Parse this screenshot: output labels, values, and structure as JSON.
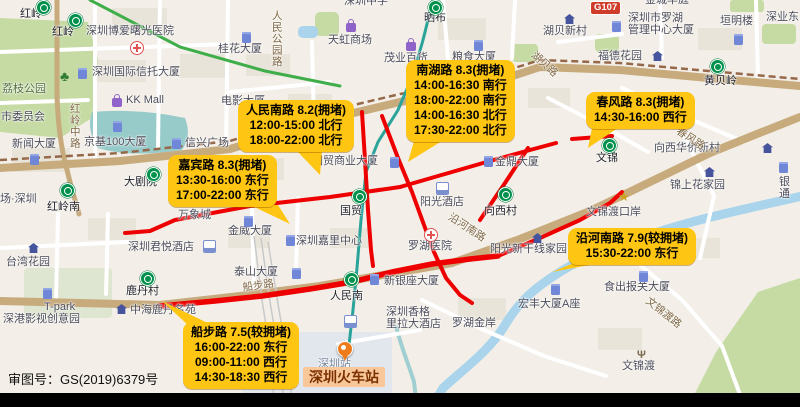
{
  "colors": {
    "callout": "#ffc513",
    "congestion": "#ee0000",
    "stationbg": "#f8c79a"
  },
  "map": {
    "attribution": "审图号：GS(2019)6379号",
    "road_badge": "G107",
    "station_highlight": "深圳火车站",
    "callouts": [
      {
        "title": "人民南路 8.2(拥堵)",
        "lines": [
          "12:00-15:00 北行",
          "18:00-22:00 北行"
        ],
        "left": 238,
        "top": 100,
        "tail": "296,150 322,150 320,175"
      },
      {
        "title": "南湖路 8.3(拥堵)",
        "lines": [
          "14:00-16:30 南行",
          "18:00-22:00 南行",
          "14:00-16:30 北行",
          "17:30-22:00 北行"
        ],
        "left": 406,
        "top": 60,
        "tail": "414,141 442,141 408,162"
      },
      {
        "title": "春风路 8.3(拥堵)",
        "lines": [
          "14:30-16:00 西行"
        ],
        "left": 586,
        "top": 92,
        "tail": "592,128 618,128 588,148"
      },
      {
        "title": "嘉宾路 8.3(拥堵)",
        "lines": [
          "13:30-16:00 东行",
          "17:00-22:00 东行"
        ],
        "left": 168,
        "top": 155,
        "tail": "250,205 278,205 290,224"
      },
      {
        "title": "沿河南路 7.9(较拥堵)",
        "lines": [
          "15:30-22:00 东行"
        ],
        "left": 568,
        "top": 228,
        "tail": "574,263 600,263 552,272"
      },
      {
        "title": "船步路 7.5(较拥堵)",
        "lines": [
          "16:00-22:00 东行",
          "09:00-11:00 西行",
          "14:30-18:30 西行"
        ],
        "left": 183,
        "top": 322,
        "tail": "190,327 216,327 162,301"
      }
    ],
    "labels": [
      {
        "t": "红岭",
        "x": 20,
        "y": 8,
        "c": "st"
      },
      {
        "t": "红岭",
        "x": 52,
        "y": 26,
        "c": "st"
      },
      {
        "t": "深圳博爱曙光医院",
        "x": 86,
        "y": 25
      },
      {
        "t": "桂花大厦",
        "x": 218,
        "y": 43
      },
      {
        "t": "深圳国际信托大厦",
        "x": 92,
        "y": 66
      },
      {
        "t": "KK Mall",
        "x": 126,
        "y": 94
      },
      {
        "t": "荔枝公园",
        "x": 2,
        "y": 83,
        "c": "park"
      },
      {
        "t": "市委员会",
        "x": 1,
        "y": 111
      },
      {
        "t": "新闻大厦",
        "x": 12,
        "y": 138
      },
      {
        "t": "京基100大厦",
        "x": 84,
        "y": 136
      },
      {
        "t": "信兴广场",
        "x": 185,
        "y": 137
      },
      {
        "t": "大剧院",
        "x": 124,
        "y": 176,
        "c": "st"
      },
      {
        "t": "红岭南",
        "x": 47,
        "y": 201,
        "c": "st"
      },
      {
        "t": "场·深圳",
        "x": 0,
        "y": 193
      },
      {
        "t": "深圳中学",
        "x": 344,
        "y": -5
      },
      {
        "t": "晒布",
        "x": 424,
        "y": 12,
        "c": "st"
      },
      {
        "t": "天虹商场",
        "x": 328,
        "y": 34
      },
      {
        "t": "茂业百货",
        "x": 384,
        "y": 52
      },
      {
        "t": "粮食大厦",
        "x": 452,
        "y": 51
      },
      {
        "t": "电影大厦",
        "x": 221,
        "y": 95
      },
      {
        "t": "国贸商业大厦",
        "x": 312,
        "y": 155
      },
      {
        "t": "国贸",
        "x": 340,
        "y": 205,
        "c": "st"
      },
      {
        "t": "阳光酒店",
        "x": 420,
        "y": 196
      },
      {
        "t": "金鼎大厦",
        "x": 495,
        "y": 156
      },
      {
        "t": "向西村",
        "x": 484,
        "y": 205,
        "c": "st"
      },
      {
        "t": "文锦",
        "x": 596,
        "y": 152,
        "c": "st"
      },
      {
        "t": "向西华侨新村",
        "x": 654,
        "y": 142
      },
      {
        "t": "锦上花家园",
        "x": 670,
        "y": 179
      },
      {
        "t": "银通",
        "x": 779,
        "y": 176
      },
      {
        "t": "文锦渡口岸",
        "x": 586,
        "y": 206
      },
      {
        "t": "湖贝新村",
        "x": 543,
        "y": 25
      },
      {
        "t": "深圳市罗湖\n管理中心大厦",
        "x": 628,
        "y": 12
      },
      {
        "t": "垣明楼",
        "x": 720,
        "y": 15
      },
      {
        "t": "深业东",
        "x": 766,
        "y": 11
      },
      {
        "t": "金城华庭",
        "x": 645,
        "y": -6
      },
      {
        "t": "福德花园",
        "x": 598,
        "y": 50
      },
      {
        "t": "黄贝岭",
        "x": 704,
        "y": 75,
        "c": "st"
      },
      {
        "t": "深圳嘉里中心",
        "x": 296,
        "y": 235
      },
      {
        "t": "金威大厦",
        "x": 228,
        "y": 225
      },
      {
        "t": "万象城",
        "x": 178,
        "y": 209
      },
      {
        "t": "深圳君悦酒店",
        "x": 128,
        "y": 241
      },
      {
        "t": "台湾花园",
        "x": 6,
        "y": 256
      },
      {
        "t": "鹿丹村",
        "x": 126,
        "y": 285,
        "c": "st"
      },
      {
        "t": "T-park",
        "x": 44,
        "y": 301
      },
      {
        "t": "深港影视创意园",
        "x": 3,
        "y": 313
      },
      {
        "t": "中海鹿丹名苑",
        "x": 130,
        "y": 304
      },
      {
        "t": "泰山大厦",
        "x": 234,
        "y": 266
      },
      {
        "t": "人民南",
        "x": 330,
        "y": 290,
        "c": "st"
      },
      {
        "t": "新银座大厦",
        "x": 384,
        "y": 275
      },
      {
        "t": "深圳香格\n里拉大酒店",
        "x": 386,
        "y": 306
      },
      {
        "t": "罗湖医院",
        "x": 408,
        "y": 240
      },
      {
        "t": "阳光新干线家园",
        "x": 490,
        "y": 243
      },
      {
        "t": "罗湖金岸",
        "x": 452,
        "y": 317
      },
      {
        "t": "宏丰大厦A座",
        "x": 518,
        "y": 298
      },
      {
        "t": "食出报关大厦",
        "x": 604,
        "y": 281
      },
      {
        "t": "文锦渡",
        "x": 622,
        "y": 360
      },
      {
        "t": "深圳站",
        "x": 318,
        "y": 358,
        "c": "dim"
      },
      {
        "t": "红岭中路",
        "x": 68,
        "y": 103,
        "c": "road v"
      },
      {
        "t": "人民公园路",
        "x": 270,
        "y": 10,
        "c": "road v"
      },
      {
        "t": "湖贝路",
        "x": 536,
        "y": 50,
        "c": "road",
        "r": 42
      },
      {
        "t": "春风路",
        "x": 680,
        "y": 126,
        "c": "road",
        "r": 33
      },
      {
        "t": "文锦渡路",
        "x": 650,
        "y": 296,
        "c": "road",
        "r": 38
      },
      {
        "t": "沿河南路",
        "x": 452,
        "y": 212,
        "c": "road",
        "r": 33
      },
      {
        "t": "船步路",
        "x": 242,
        "y": 283,
        "c": "road",
        "r": -8
      }
    ],
    "icons": [
      {
        "k": "metro",
        "x": 36,
        "y": 0
      },
      {
        "k": "metro",
        "x": 68,
        "y": 13
      },
      {
        "k": "metro",
        "x": 428,
        "y": 0
      },
      {
        "k": "metro",
        "x": 60,
        "y": 183
      },
      {
        "k": "metro",
        "x": 146,
        "y": 167
      },
      {
        "k": "metro",
        "x": 352,
        "y": 189
      },
      {
        "k": "metro",
        "x": 498,
        "y": 187
      },
      {
        "k": "metro",
        "x": 602,
        "y": 138
      },
      {
        "k": "metro",
        "x": 710,
        "y": 59
      },
      {
        "k": "metro",
        "x": 140,
        "y": 271
      },
      {
        "k": "metro",
        "x": 344,
        "y": 272
      },
      {
        "k": "hospital",
        "x": 130,
        "y": 41
      },
      {
        "k": "hospital",
        "x": 424,
        "y": 228
      },
      {
        "k": "bag",
        "x": 346,
        "y": 20
      },
      {
        "k": "bag",
        "x": 406,
        "y": 39
      },
      {
        "k": "bag",
        "x": 112,
        "y": 95
      },
      {
        "k": "bldg",
        "x": 242,
        "y": 32
      },
      {
        "k": "bldg",
        "x": 78,
        "y": 68
      },
      {
        "k": "bldg",
        "x": 474,
        "y": 40
      },
      {
        "k": "bldg",
        "x": 612,
        "y": 21
      },
      {
        "k": "bldg",
        "x": 734,
        "y": 34
      },
      {
        "k": "bldg",
        "x": 113,
        "y": 121
      },
      {
        "k": "bldg",
        "x": 172,
        "y": 138
      },
      {
        "k": "bldg",
        "x": 30,
        "y": 154
      },
      {
        "k": "bldg",
        "x": 484,
        "y": 156
      },
      {
        "k": "bldg",
        "x": 390,
        "y": 157
      },
      {
        "k": "bldg",
        "x": 286,
        "y": 235
      },
      {
        "k": "bldg",
        "x": 244,
        "y": 216
      },
      {
        "k": "bldg",
        "x": 292,
        "y": 268
      },
      {
        "k": "bldg",
        "x": 370,
        "y": 274
      },
      {
        "k": "bldg",
        "x": 551,
        "y": 284
      },
      {
        "k": "bldg",
        "x": 639,
        "y": 271
      },
      {
        "k": "bldg",
        "x": 43,
        "y": 288
      },
      {
        "k": "bldg",
        "x": 779,
        "y": 162
      },
      {
        "k": "house",
        "x": 564,
        "y": 14
      },
      {
        "k": "house",
        "x": 652,
        "y": 51
      },
      {
        "k": "house",
        "x": 762,
        "y": 143
      },
      {
        "k": "house",
        "x": 28,
        "y": 243
      },
      {
        "k": "house",
        "x": 116,
        "y": 304
      },
      {
        "k": "house",
        "x": 704,
        "y": 167
      },
      {
        "k": "house",
        "x": 532,
        "y": 233
      },
      {
        "k": "hotel",
        "x": 436,
        "y": 182
      },
      {
        "k": "hotel",
        "x": 344,
        "y": 315
      },
      {
        "k": "hotel",
        "x": 203,
        "y": 240
      },
      {
        "k": "star",
        "x": 618,
        "y": 188
      },
      {
        "k": "fork",
        "x": 637,
        "y": 345
      },
      {
        "k": "tree",
        "x": 60,
        "y": 68
      },
      {
        "k": "trainpin",
        "x": 337,
        "y": 341
      }
    ]
  }
}
